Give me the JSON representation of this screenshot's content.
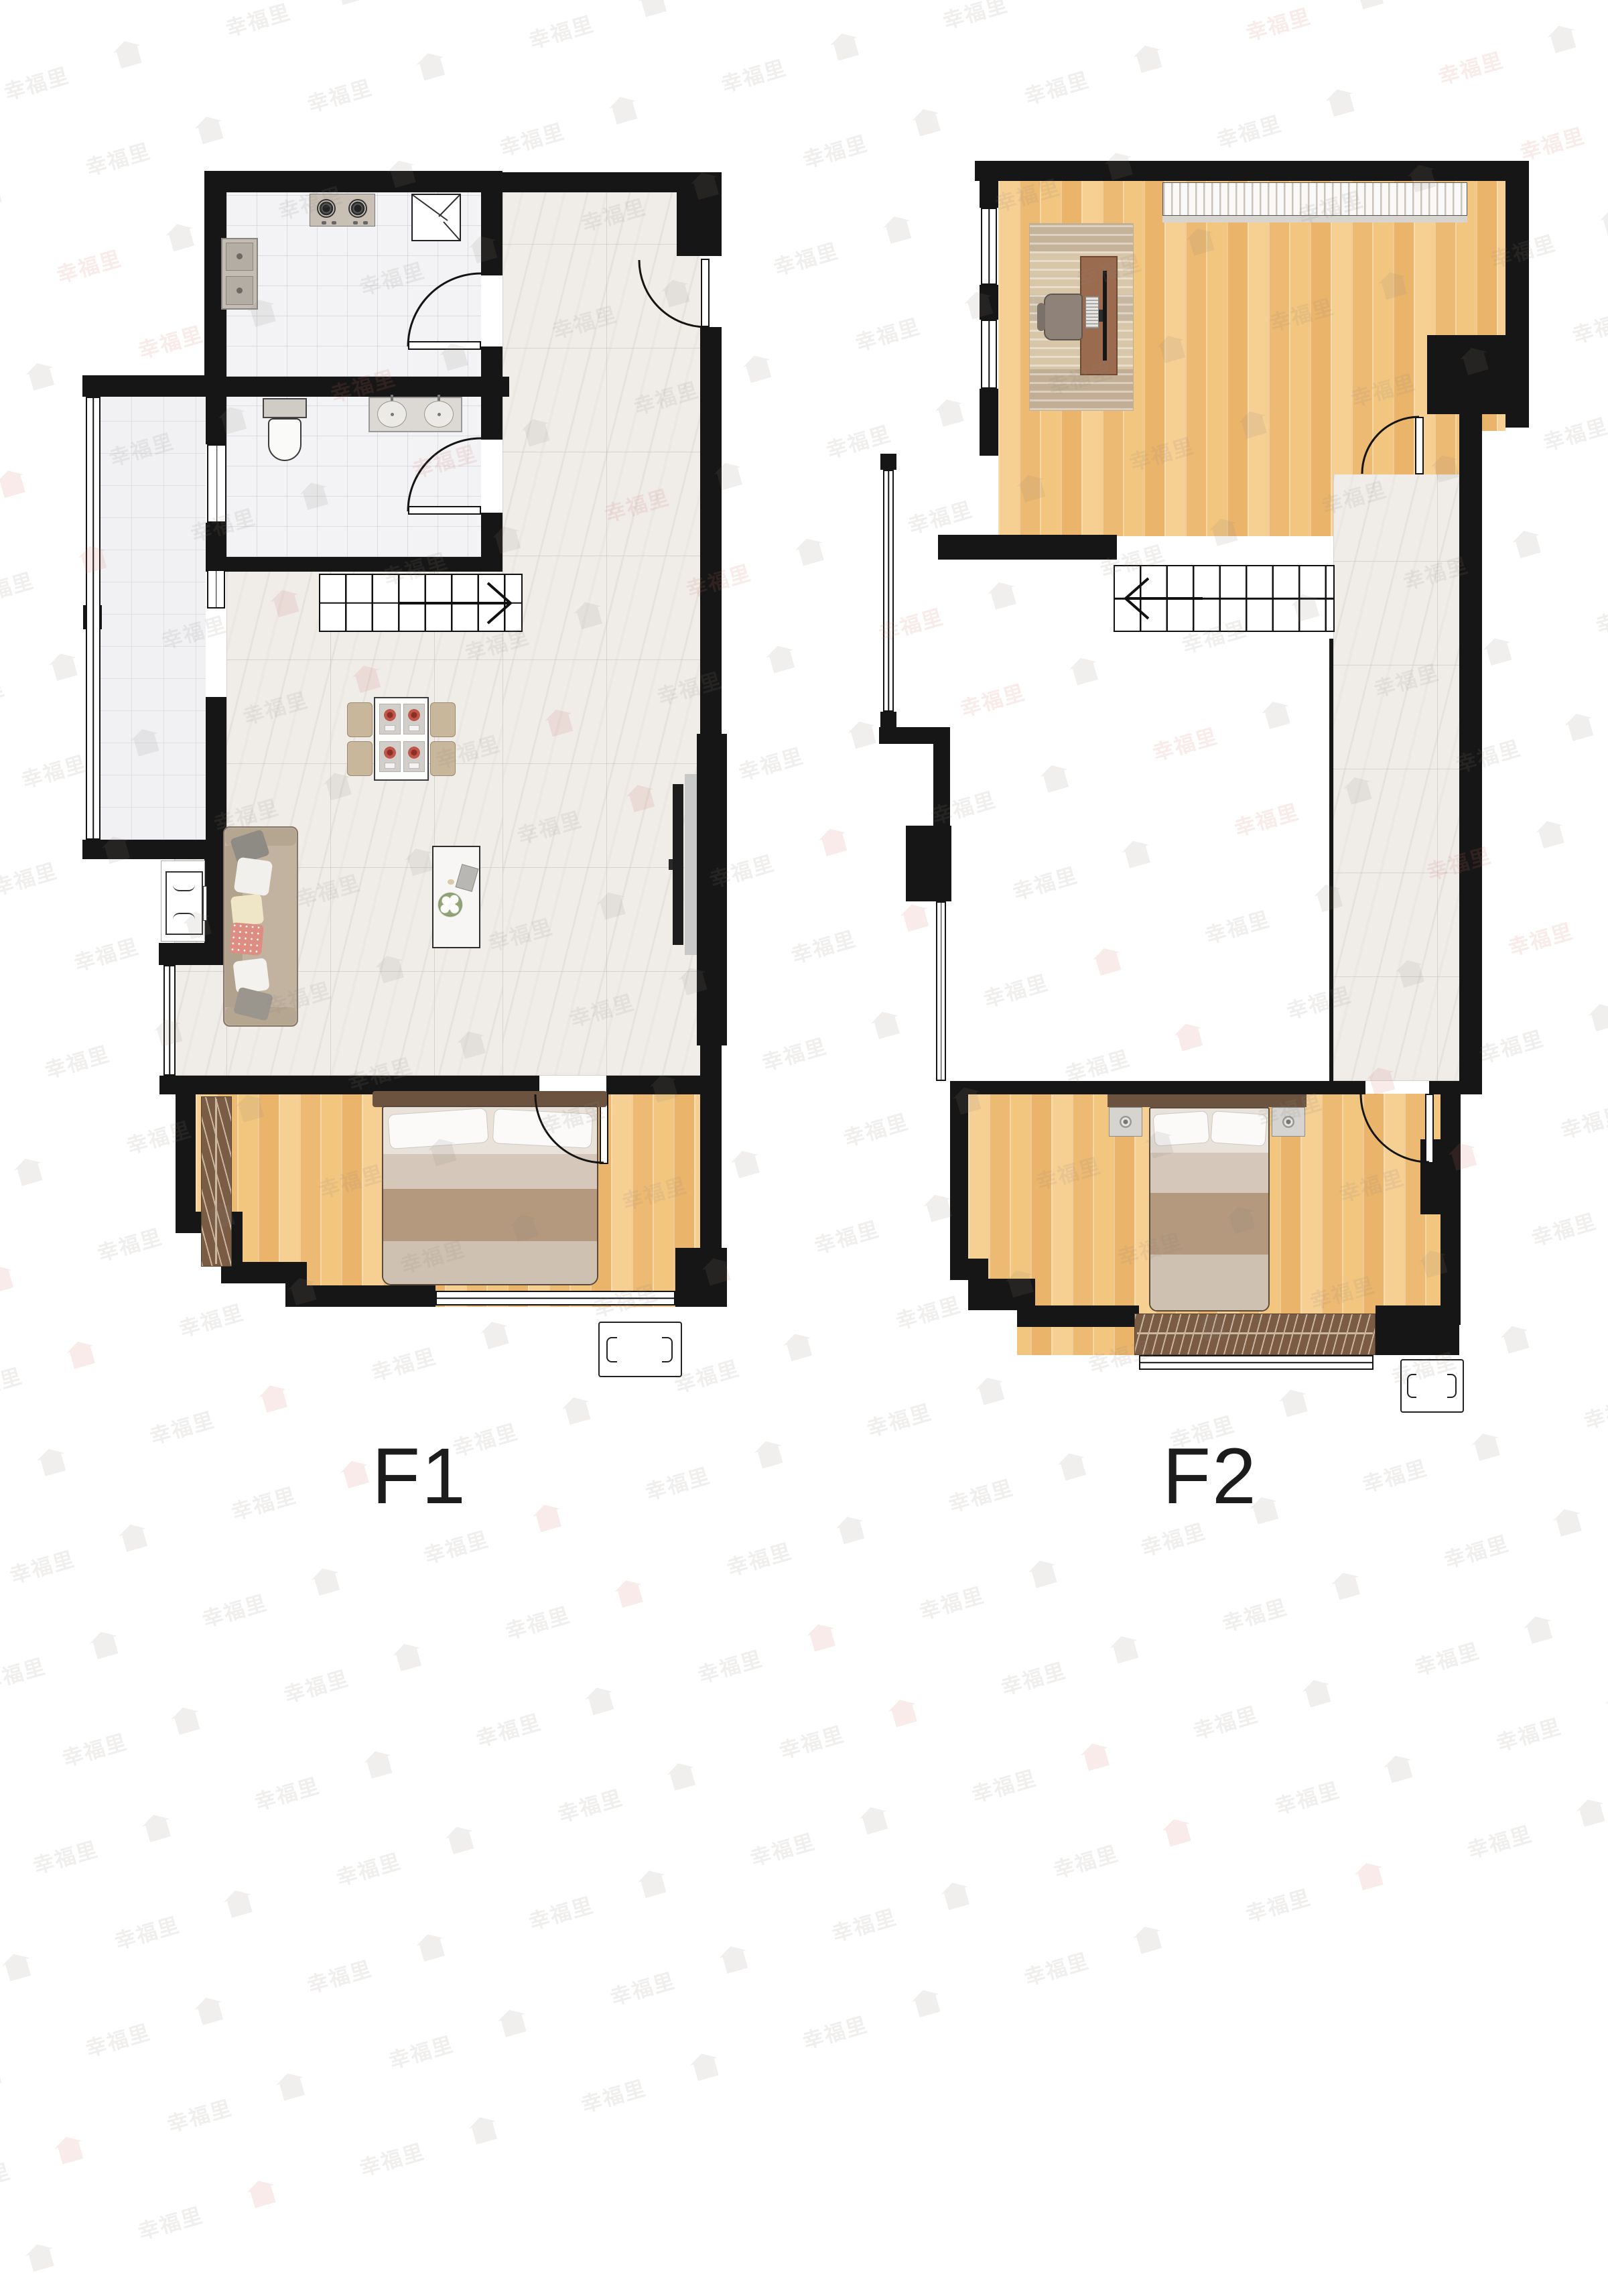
{
  "document": {
    "kind": "duplex floor plan",
    "floors": [
      {
        "id": "f1",
        "label": "F1"
      },
      {
        "id": "f2",
        "label": "F2"
      }
    ]
  },
  "watermark": {
    "text": "幸福里",
    "logo": "house-logo",
    "color_gray": "rgba(138,128,122,0.13)",
    "color_pink": "rgba(206,112,102,0.14)"
  },
  "palette": {
    "wall": "#161616",
    "wood_floor": "#f1c37f",
    "marble_floor": "#f0ede9",
    "white_tile": "#f3f3f5",
    "sofa": "#c2b3a0",
    "bed_headboard": "#6b5340",
    "blanket_tan": "#b4997f",
    "wardrobe": "#7a5b44",
    "accent_pillow": "#e08f85"
  },
  "rooms": {
    "f1": [
      "kitchen",
      "bathroom",
      "balcony",
      "entry",
      "living-dining",
      "stairs",
      "bedroom"
    ],
    "f2": [
      "study",
      "void",
      "stairs",
      "corridor",
      "bedroom"
    ]
  },
  "furniture": {
    "f1": [
      "gas-stove",
      "corner-cabinet",
      "kitchen-sink",
      "toilet",
      "double-vanity",
      "dining-table-4-chairs",
      "sofa",
      "side-table",
      "coffee-table",
      "tv-panel",
      "double-bed",
      "wardrobe",
      "air-conditioner"
    ],
    "f2": [
      "bookshelf",
      "desk",
      "office-chair",
      "rug",
      "double-bed",
      "nightstands",
      "wardrobe",
      "air-conditioner"
    ]
  }
}
